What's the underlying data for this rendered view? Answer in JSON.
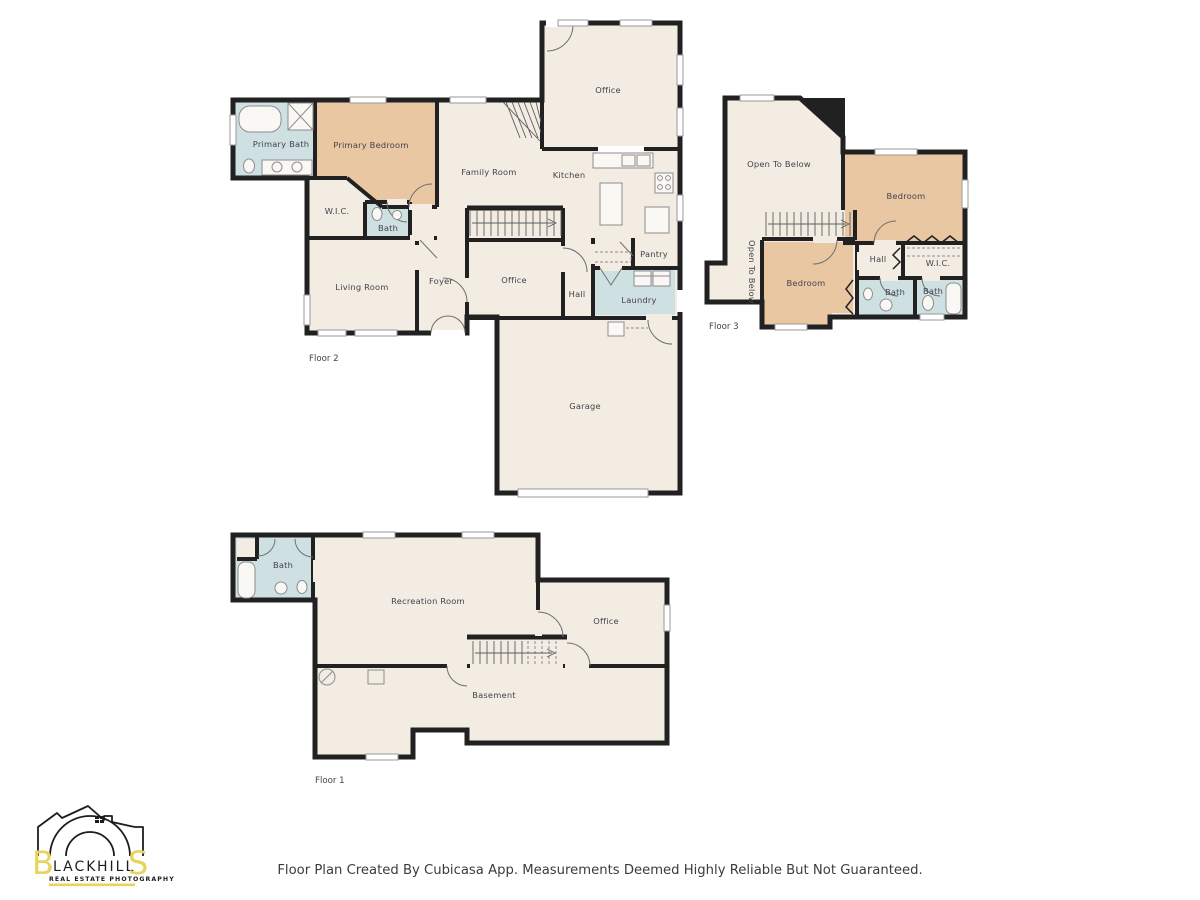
{
  "page": {
    "background": "#ffffff",
    "caption": "Floor Plan Created By Cubicasa App. Measurements Deemed Highly Reliable But Not Guaranteed."
  },
  "palette": {
    "floor_fill": "#f2ece2",
    "bedroom_fill": "#eac7a3",
    "bath_fill": "#cfe0e3",
    "wall": "#212121",
    "label_text": "#43434c",
    "logo_yellow": "#e7d45f",
    "logo_ink": "#1d1d1b"
  },
  "logo": {
    "first": "B",
    "mid1": "LACK",
    "mid2": "HILL",
    "last": "S",
    "tagline": "REAL ESTATE PHOTOGRAPHY"
  },
  "floors": {
    "floor2": {
      "label": "Floor 2",
      "rooms": {
        "primary_bath": "Primary Bath",
        "primary_bedroom": "Primary Bedroom",
        "family_room": "Family Room",
        "kitchen": "Kitchen",
        "office_upper": "Office",
        "wic": "W.I.C.",
        "bath": "Bath",
        "living_room": "Living Room",
        "foyer": "Foyer",
        "office": "Office",
        "hall": "Hall",
        "pantry": "Pantry",
        "laundry": "Laundry",
        "garage": "Garage"
      }
    },
    "floor3": {
      "label": "Floor 3",
      "rooms": {
        "open_to_below": "Open To Below",
        "open_to_below_side": "Open To Below",
        "bedroom_upper": "Bedroom",
        "bedroom_lower": "Bedroom",
        "hall": "Hall",
        "wic": "W.I.C.",
        "bath_left": "Bath",
        "bath_right": "Bath"
      }
    },
    "floor1": {
      "label": "Floor 1",
      "rooms": {
        "bath": "Bath",
        "recreation_room": "Recreation Room",
        "office": "Office",
        "basement": "Basement"
      }
    }
  }
}
